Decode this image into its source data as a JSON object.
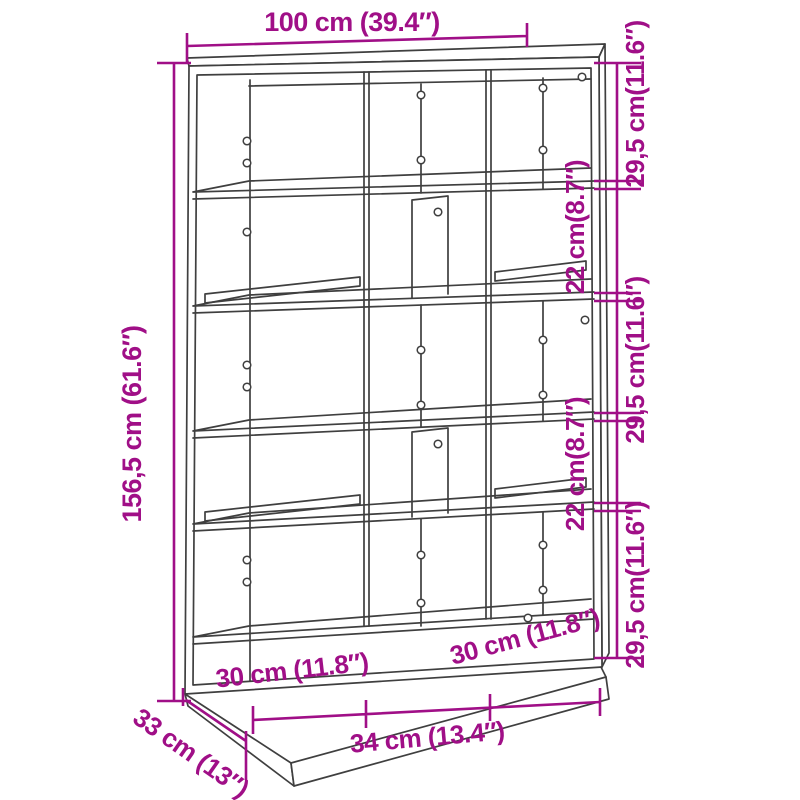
{
  "diagram": {
    "type": "product-dimension-diagram",
    "product": "bookcase-room-divider-line-drawing",
    "dimensions": {
      "top_width": "100 cm (39.4″)",
      "left_height": "156,5 cm (61.6″)",
      "right_side_segments": [
        "29,5 cm(11.6″)",
        "22 cm(8.7″)",
        "29,5 cm(11.6″)",
        "22 cm(8.7″)",
        "29,5 cm(11.6″)"
      ],
      "bottom_compartments": [
        "30 cm (11.8″)",
        "34 cm (13.4″)",
        "30 cm (11.8″)"
      ],
      "depth": "33 cm (13″)"
    },
    "colors": {
      "dimension": "#A00F87",
      "drawing": "#3F3F3F",
      "background": "#FFFFFF"
    }
  }
}
